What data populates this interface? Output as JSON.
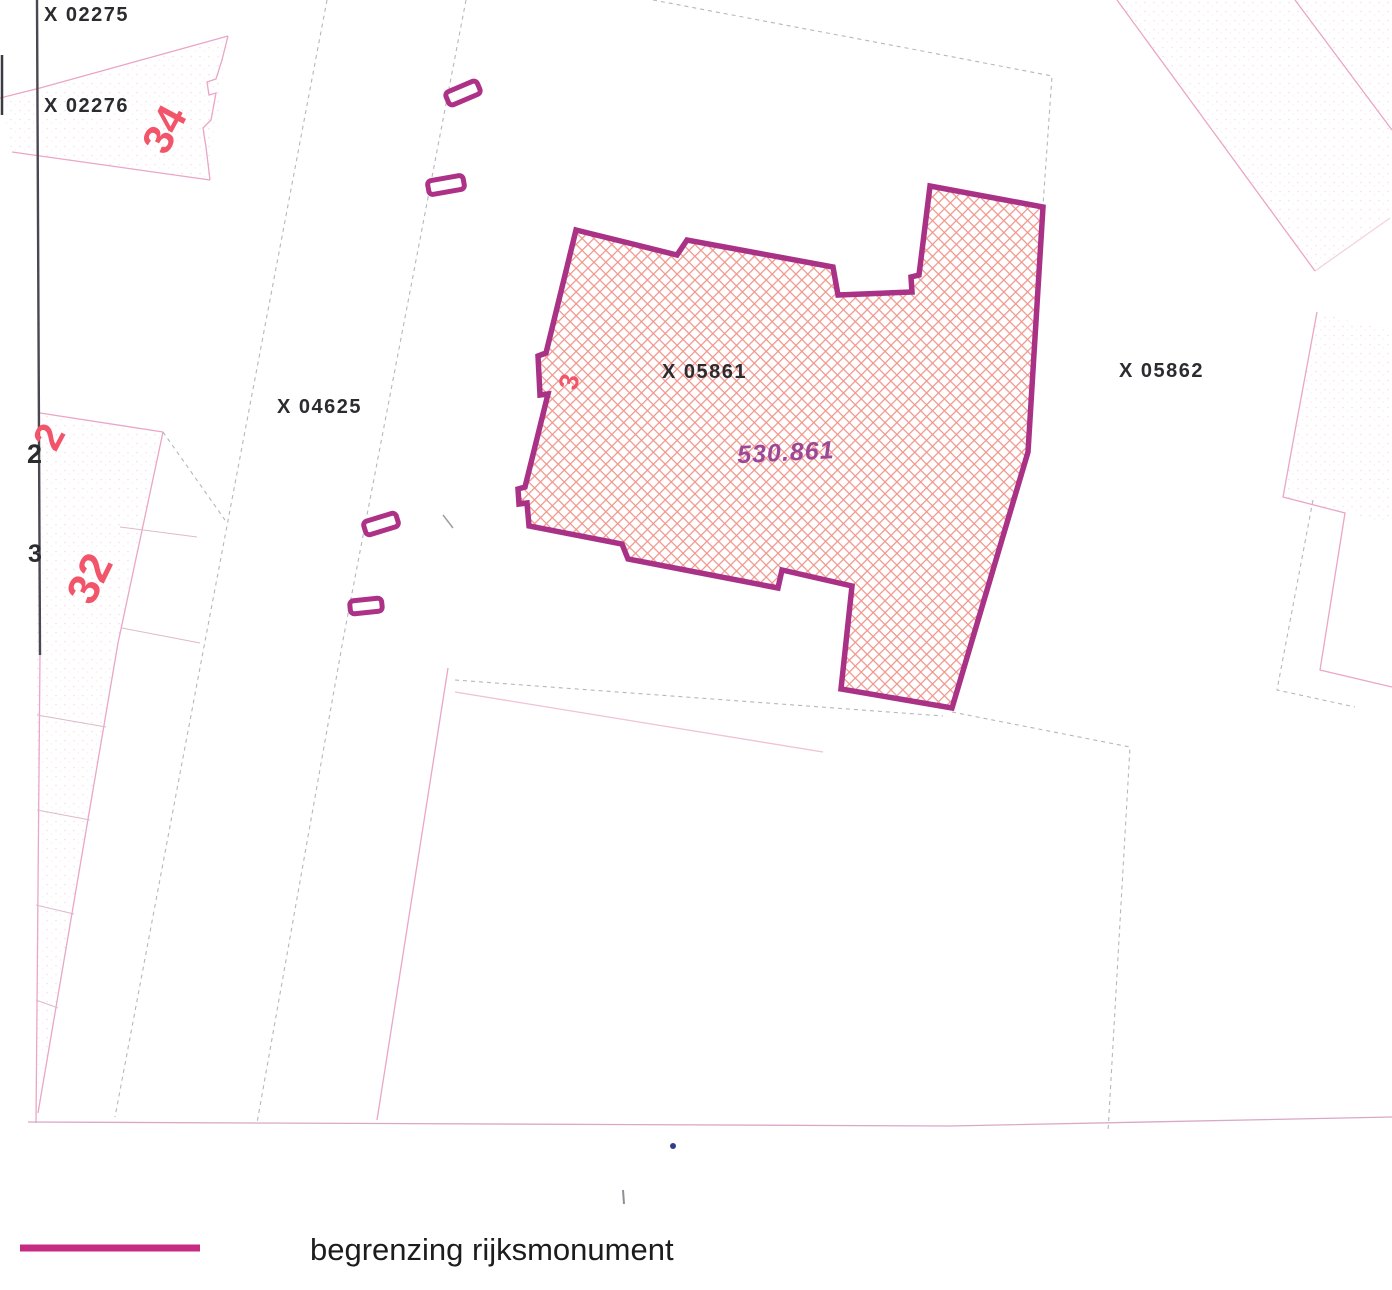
{
  "map": {
    "parcel_labels": [
      {
        "text": "X 02275"
      },
      {
        "text": "X 02276"
      },
      {
        "text": "X 04625"
      },
      {
        "text": "X 05861"
      },
      {
        "text": "X 05862"
      }
    ],
    "monument": {
      "area_label": "530.861"
    },
    "house_numbers": [
      {
        "text": "34"
      },
      {
        "text": "2"
      },
      {
        "text": "32"
      },
      {
        "text": "3"
      }
    ],
    "partial_numbers": [
      {
        "text": "2"
      },
      {
        "text": "3"
      }
    ]
  },
  "legend": {
    "label": "begrenzing rijksmonument"
  },
  "colors": {
    "monument_boundary": "#A93286",
    "legend_line": "#C52B80",
    "hatch_line": "#F0968C",
    "house_number_pink": "#F2556A",
    "area_label_purple": "#9D4795",
    "label_black": "#2B2B30"
  }
}
